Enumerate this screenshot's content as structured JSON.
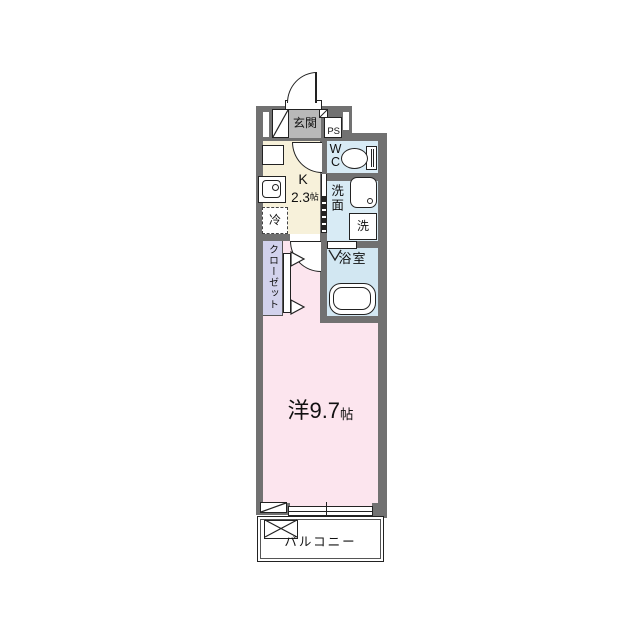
{
  "plan_title": "studio-apartment-floor-plan",
  "rooms": {
    "entrance": {
      "label": "玄関"
    },
    "pipe_space": {
      "label": "PS"
    },
    "toilet": {
      "lines": [
        "W",
        "C"
      ]
    },
    "kitchen": {
      "label": "K",
      "size": "2.3",
      "unit": "帖"
    },
    "refrigerator": {
      "label": "冷"
    },
    "washroom": {
      "label": "洗面"
    },
    "washer": {
      "label": "洗"
    },
    "bathroom": {
      "label": "浴室"
    },
    "closet": {
      "label": "クローゼット"
    },
    "living_room": {
      "label": "洋",
      "size": "9.7",
      "unit": "帖"
    },
    "balcony": {
      "label": "バルコニー"
    }
  },
  "colors": {
    "wall": "#717171",
    "entrance_tile": "#b9b9b9",
    "kitchen_floor": "#f7f1da",
    "wc_floor": "#d8ebf5",
    "washroom_floor": "#d8ebf5",
    "bath_floor": "#d2e7f2",
    "closet_floor": "#d2d2ec",
    "room_floor": "#fce5ee",
    "balcony_floor": "#ffffff",
    "line": "#222222"
  }
}
